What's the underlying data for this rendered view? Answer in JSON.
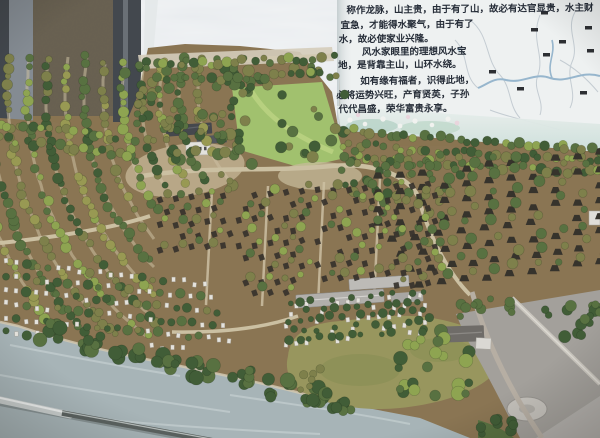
{
  "scene": {
    "type": "photograph",
    "subject": "Indoor scale terrain model of a hillside feng-shui cemetery park with an explanation board",
    "width": 600,
    "height": 438
  },
  "poster": {
    "lines": [
      "称作龙脉，山主贵，由于有了山，故必有达官显贵，水主财",
      "宜急，才能得水聚气，由于有了",
      "水，故必使家业兴隆。",
      "风水家眼里的理想风水宝",
      "地，是背靠主山，山环水绕。",
      "如有缘有福者，识得此地，",
      "必将运势兴旺，产育贤英，子孙",
      "代代昌盛，荣华富贵永享。"
    ]
  },
  "palette": {
    "wall_dark": "#41464b",
    "wall_mid": "#858c92",
    "pillar": "#a59e90",
    "wall_light": "#ced3d6",
    "poster_bg": "#f3f6f5",
    "poster_text": "#232a35",
    "earth": "#8b7551",
    "earth_light": "#c7b795",
    "path": "#cfc3a3",
    "tree_dark": "#3f5c33",
    "tree_mid": "#57713e",
    "tree_olive": "#7e8148",
    "tree_yellow": "#9a9b51",
    "tree_bright": "#8fa64f",
    "lawn": "#a3c46d",
    "lawn_light": "#bcd680",
    "tomb_dark": "#343028",
    "tomb_white": "#e9e7df",
    "roof_gray": "#b3b1ac",
    "roof_dark": "#43464a",
    "bldg_white": "#e8e6e0",
    "water": "#a9b7b9",
    "water_light": "#c9d3d3",
    "pond": "#99975c",
    "pond_dark": "#7e8a4a",
    "plaza": "#a5a29c",
    "plaza_light": "#b7b4ae",
    "river": "#8fb3cc",
    "map_line": "#c3ccd2",
    "marker": "#15171a",
    "stick_dark": "#5a615e",
    "stick_light": "#ccd2d0",
    "flower_white": "#f6f7f3",
    "flower_pink": "#eed9e0",
    "flower_band": "#d8e8df"
  }
}
